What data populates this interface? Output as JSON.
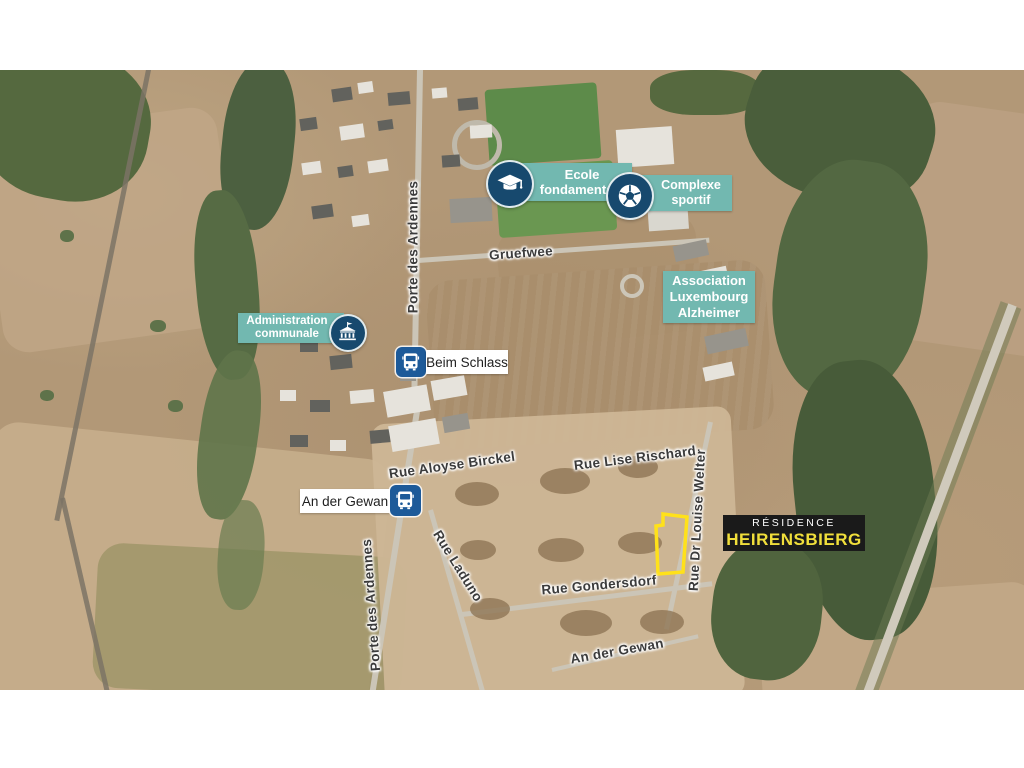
{
  "colors": {
    "label_teal": "#72b8b0",
    "icon_navy": "#17496e",
    "bus_blue": "#1d5a99",
    "residence_bg": "#1a1a1a",
    "residence_yellow": "#f1df3b",
    "parcel_yellow": "#ffe11a",
    "street_text": "#3b3b3b"
  },
  "pois": {
    "ecole": {
      "line1": "Ecole",
      "line2": "fondamentale",
      "icon": "graduation-cap-icon"
    },
    "complexe": {
      "line1": "Complexe",
      "line2": "sportif",
      "icon": "soccer-ball-icon"
    },
    "association": {
      "line1": "Association",
      "line2": "Luxembourg",
      "line3": "Alzheimer"
    },
    "administration": {
      "line1": "Administration",
      "line2": "communale",
      "icon": "town-hall-icon"
    }
  },
  "bus_stops": {
    "beim_schlass": {
      "name": "Beim Schlass",
      "icon": "bus-icon"
    },
    "an_der_gewan": {
      "name": "An der Gewan",
      "icon": "bus-icon"
    }
  },
  "residence": {
    "line1": "RÉSIDENCE",
    "line2": "HEIRENSBIERG"
  },
  "streets": {
    "porte_des_ardennes_top": "Porte des Ardennes",
    "gruefwee": "Gruefwee",
    "rue_aloyse_birckel": "Rue Aloyse Birckel",
    "rue_lise_rischard": "Rue Lise Rischard",
    "rue_dr_louise_welter": "Rue Dr Louise Welter",
    "rue_laduno": "Rue Laduno",
    "rue_gondersdorf": "Rue Gondersdorf",
    "an_der_gewan": "An der Gewan",
    "porte_des_ardennes_bottom": "Porte des Ardennes"
  }
}
